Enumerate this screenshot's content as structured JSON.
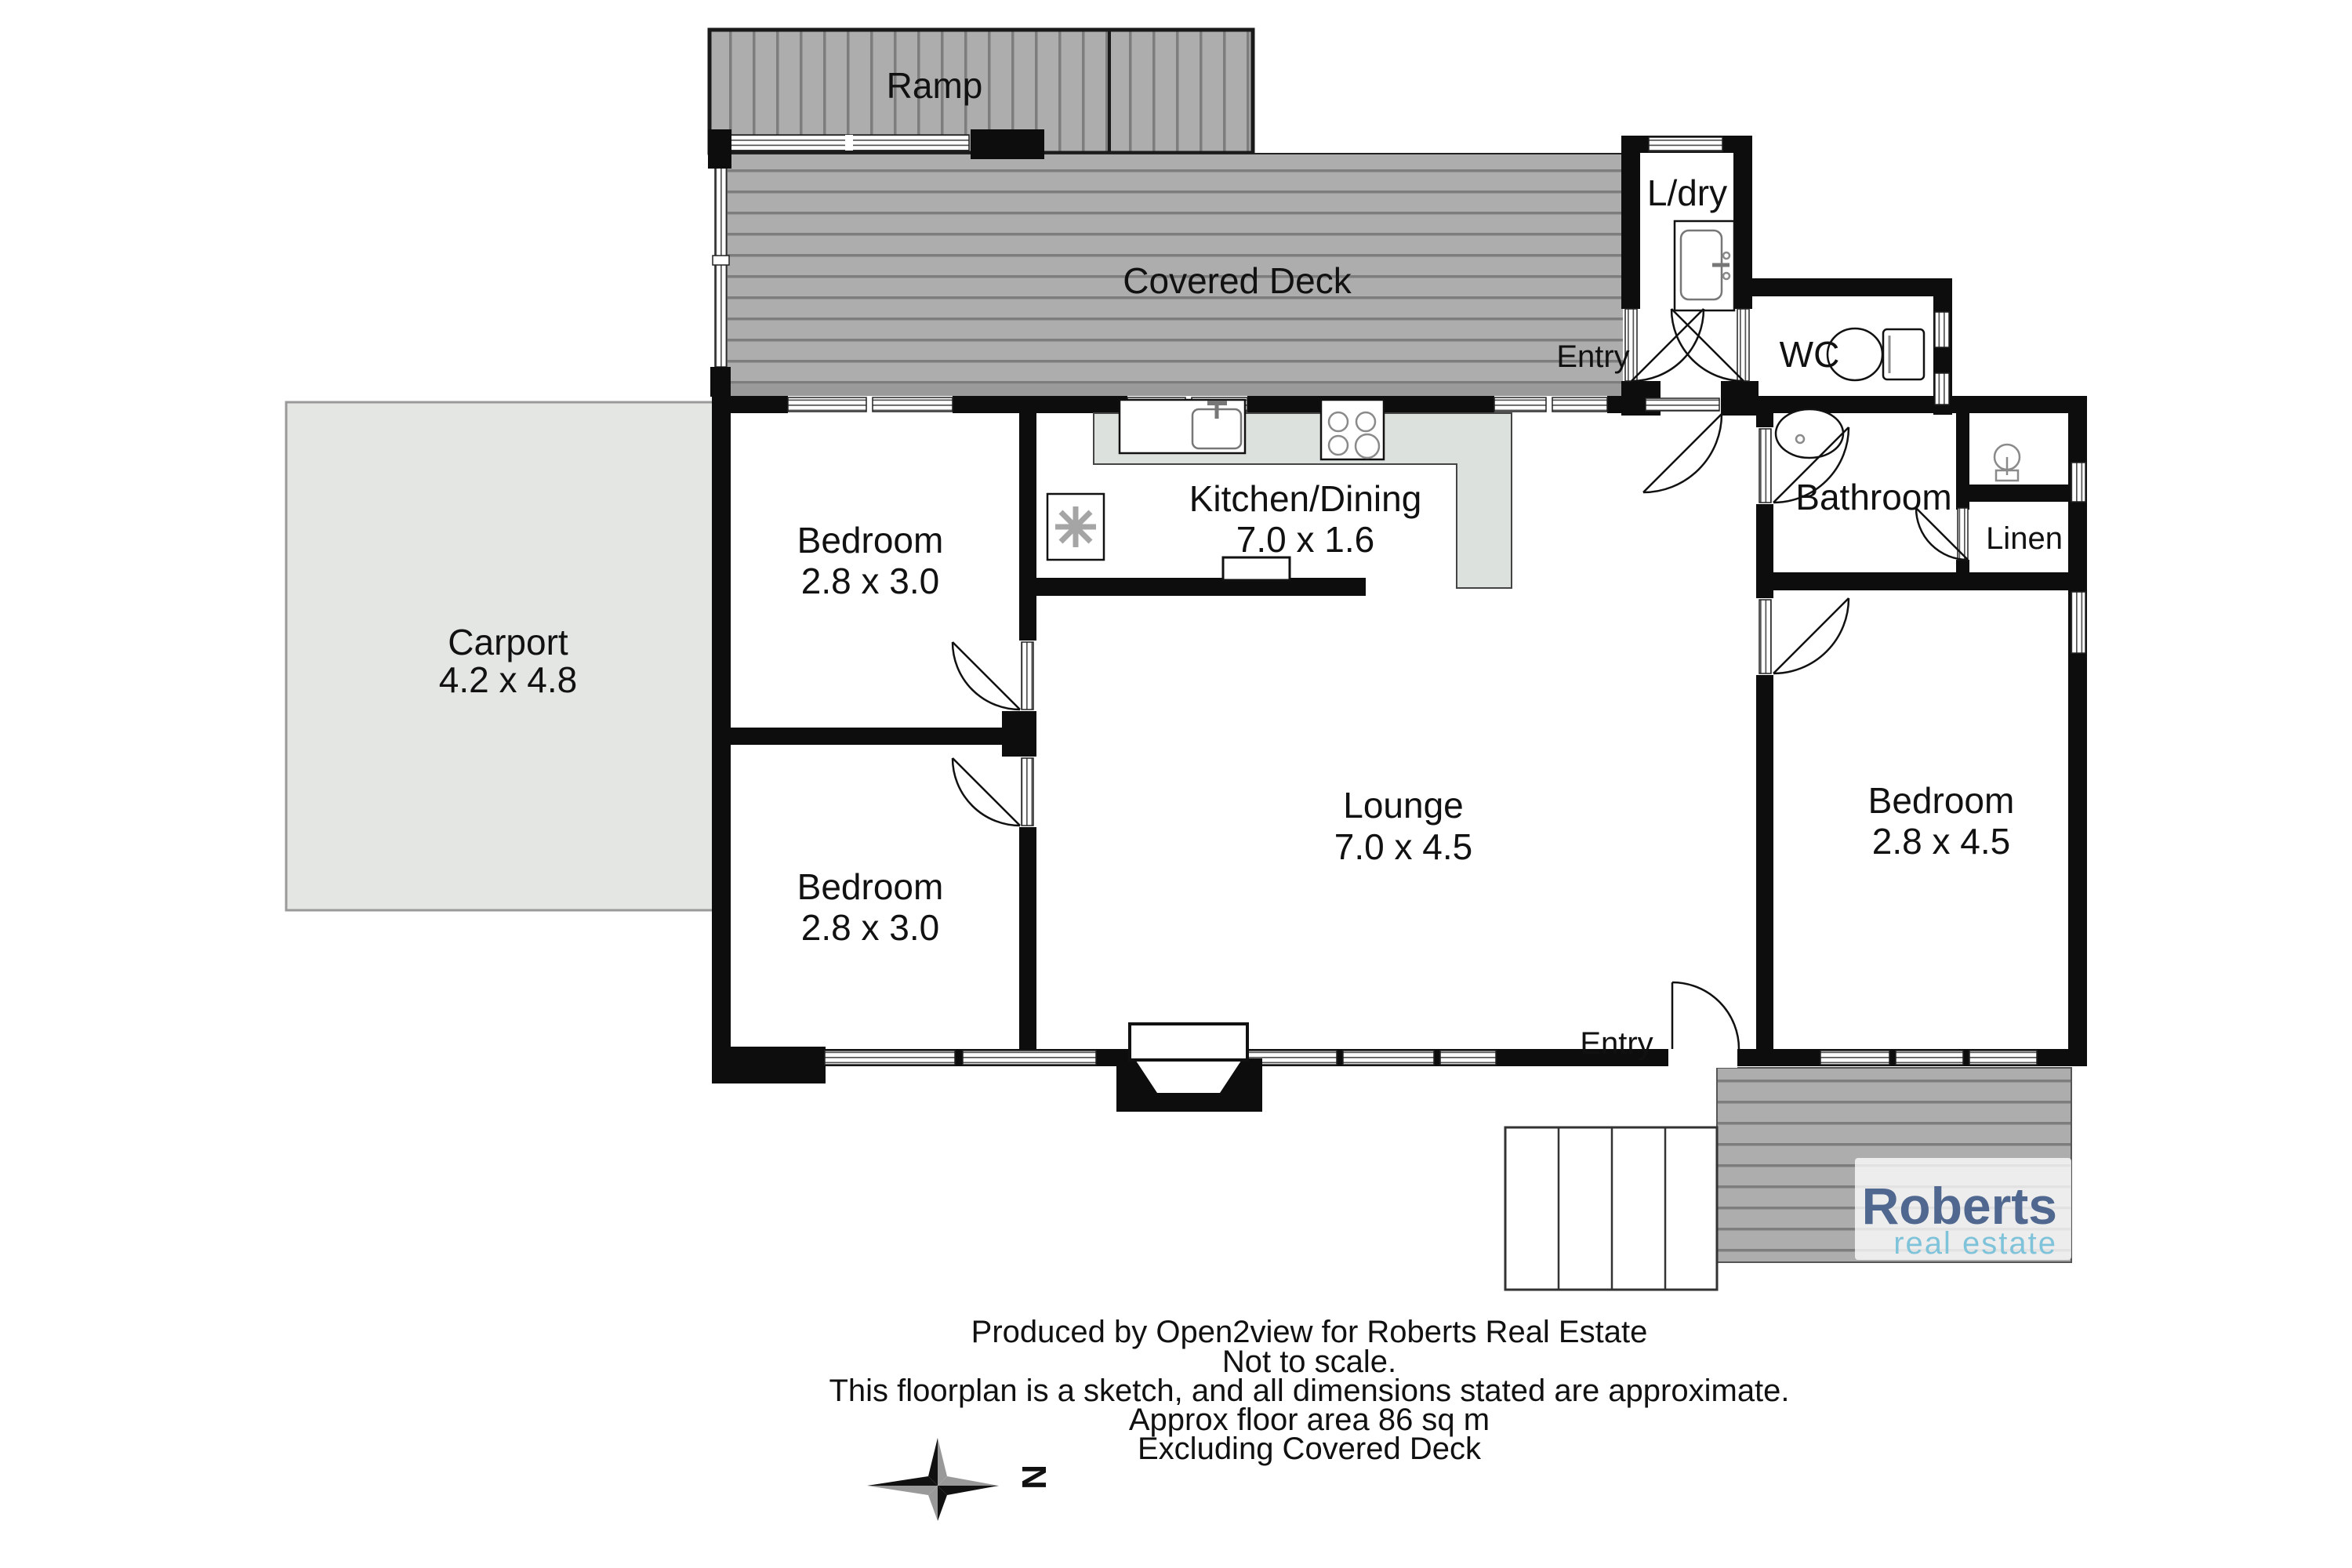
{
  "page": {
    "background": "#ffffff"
  },
  "colors": {
    "wall": "#0d0d0d",
    "text": "#111111",
    "deck_fill": "#adadad",
    "deck_stripe": "#7d7d7d",
    "carport_fill": "#e4e6e3",
    "carport_border": "#9a9a9a",
    "counter_fill": "#dde1dd",
    "logo_name": "#50688f",
    "logo_tagline": "#7fc3da",
    "compass_dark": "#111111",
    "compass_light": "#999999"
  },
  "rooms": {
    "ramp": {
      "label": "Ramp"
    },
    "covered_deck": {
      "label": "Covered Deck"
    },
    "laundry": {
      "label": "L/dry"
    },
    "entry_top": {
      "label": "Entry"
    },
    "wc": {
      "label": "WC"
    },
    "bathroom": {
      "label": "Bathroom"
    },
    "linen": {
      "label": "Linen"
    },
    "kitchen_dining": {
      "label": "Kitchen/Dining",
      "dimensions": "7.0 x 1.6"
    },
    "bedroom_1": {
      "label": "Bedroom",
      "dimensions": "2.8 x 3.0"
    },
    "bedroom_2": {
      "label": "Bedroom",
      "dimensions": "2.8 x 3.0"
    },
    "bedroom_3": {
      "label": "Bedroom",
      "dimensions": "2.8 x 4.5"
    },
    "carport": {
      "label": "Carport",
      "dimensions": "4.2 x 4.8"
    },
    "lounge": {
      "label": "Lounge",
      "dimensions": "7.0 x 4.5"
    },
    "entry_bottom": {
      "label": "Entry"
    }
  },
  "compass": {
    "north": "N"
  },
  "branding": {
    "name": "Roberts",
    "tagline": "real estate"
  },
  "footer": {
    "line1": "Produced by Open2view for Roberts Real Estate",
    "line2": "Not to scale.",
    "line3": "This floorplan is a sketch, and all dimensions stated are approximate.",
    "line4": "Approx floor area 86 sq m",
    "line5": "Excluding Covered Deck"
  }
}
